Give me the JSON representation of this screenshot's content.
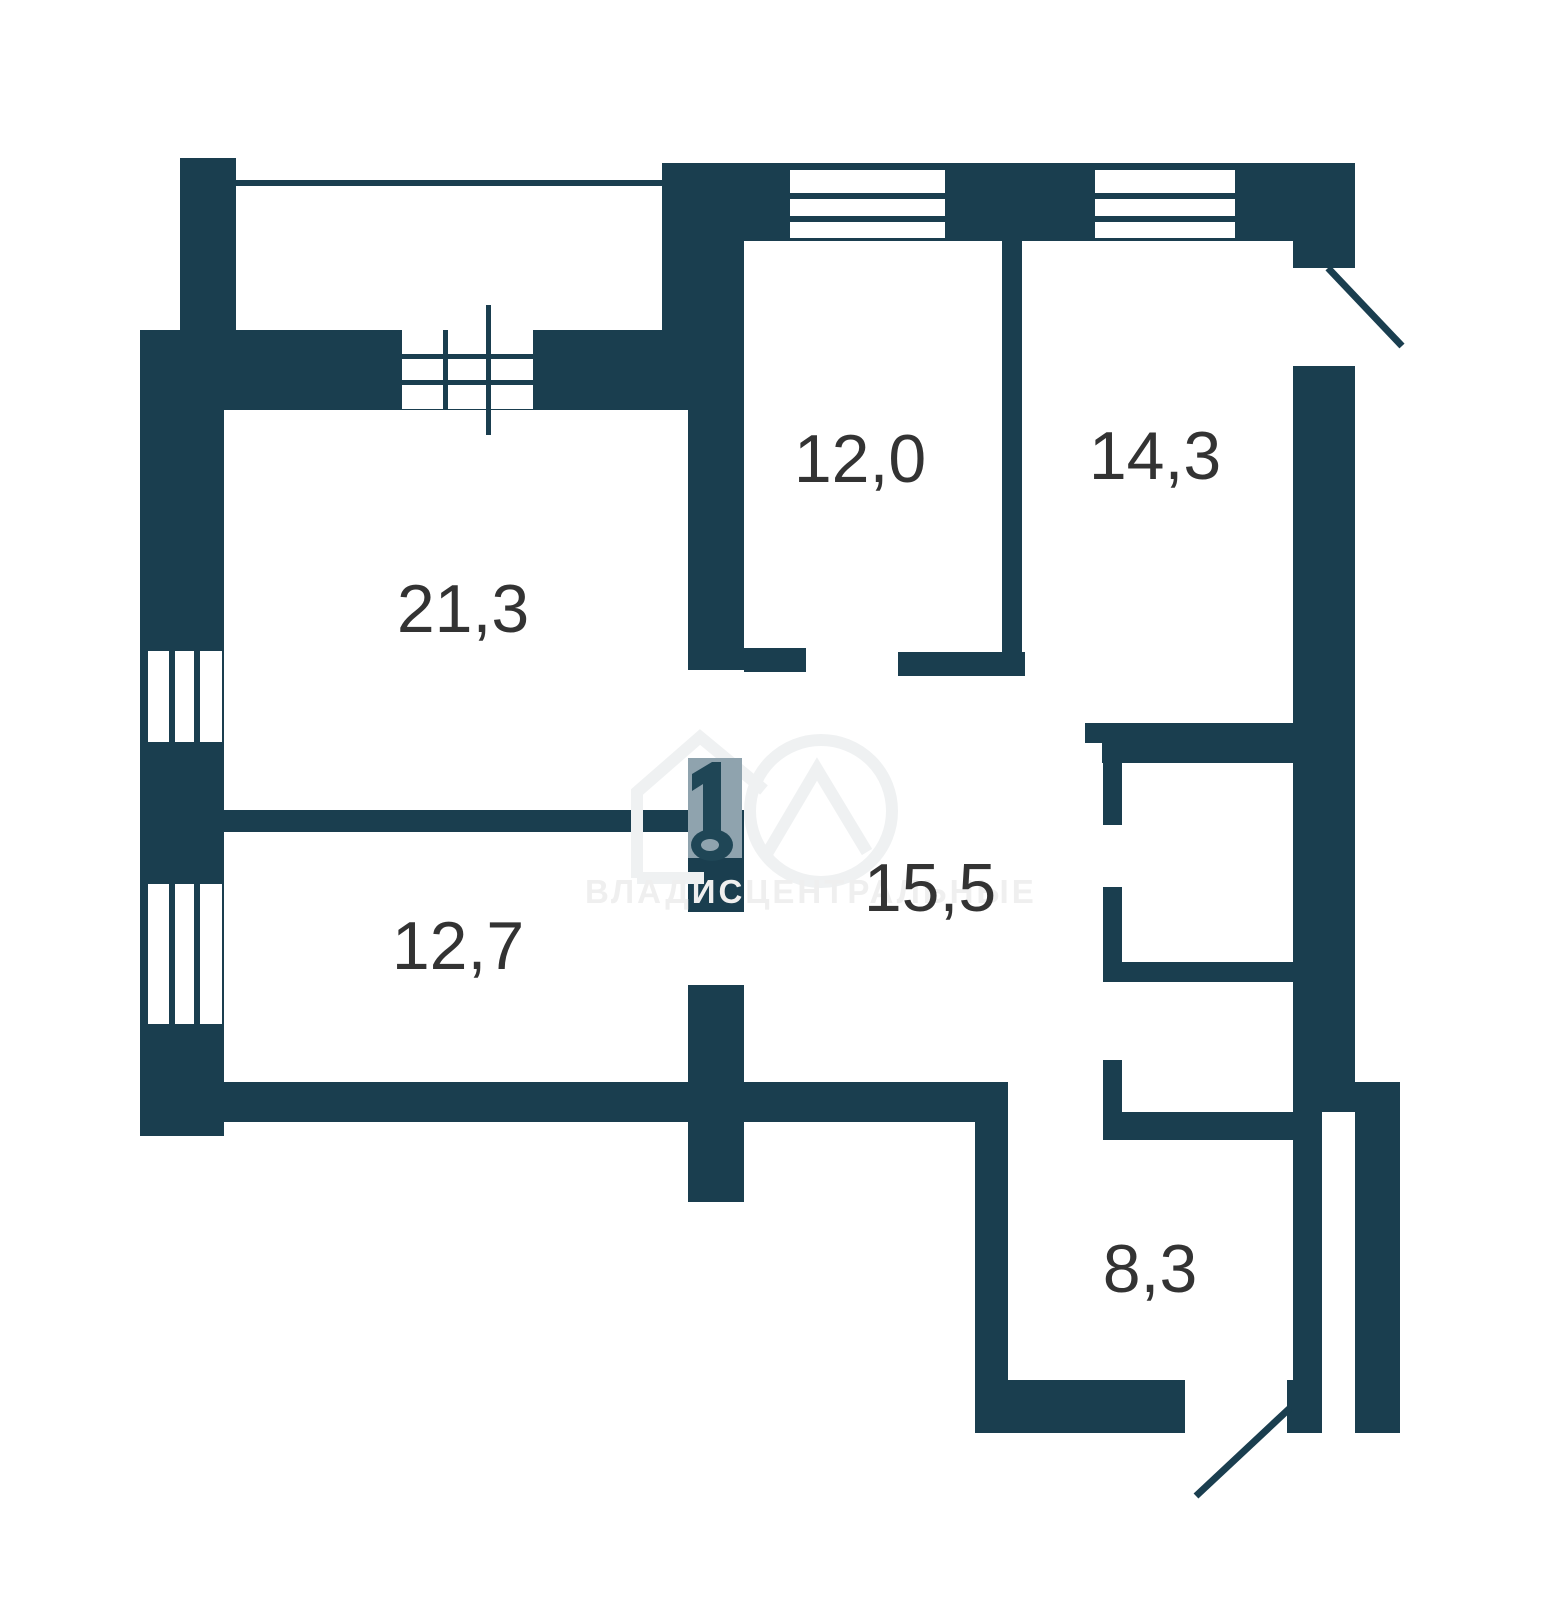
{
  "title": "apartment-floor-plan",
  "colors": {
    "wall": "#1A3E4F",
    "background": "#FFFFFF",
    "label": "#333333",
    "watermark_text": "#EFEFEF",
    "watermark_logo_block": "#8FA3AE",
    "watermark_outline": "#EFF1F2"
  },
  "rooms": [
    {
      "key": "living-room",
      "area": "21,3"
    },
    {
      "key": "bedroom-top",
      "area": "12,0"
    },
    {
      "key": "bedroom-right",
      "area": "14,3"
    },
    {
      "key": "hallway",
      "area": "15,5"
    },
    {
      "key": "bedroom-left",
      "area": "12,7"
    },
    {
      "key": "kitchen",
      "area": "8,3"
    }
  ],
  "watermark": {
    "text": "ВЛАДИСЦЕНТРАЛЬНЫЕ"
  }
}
